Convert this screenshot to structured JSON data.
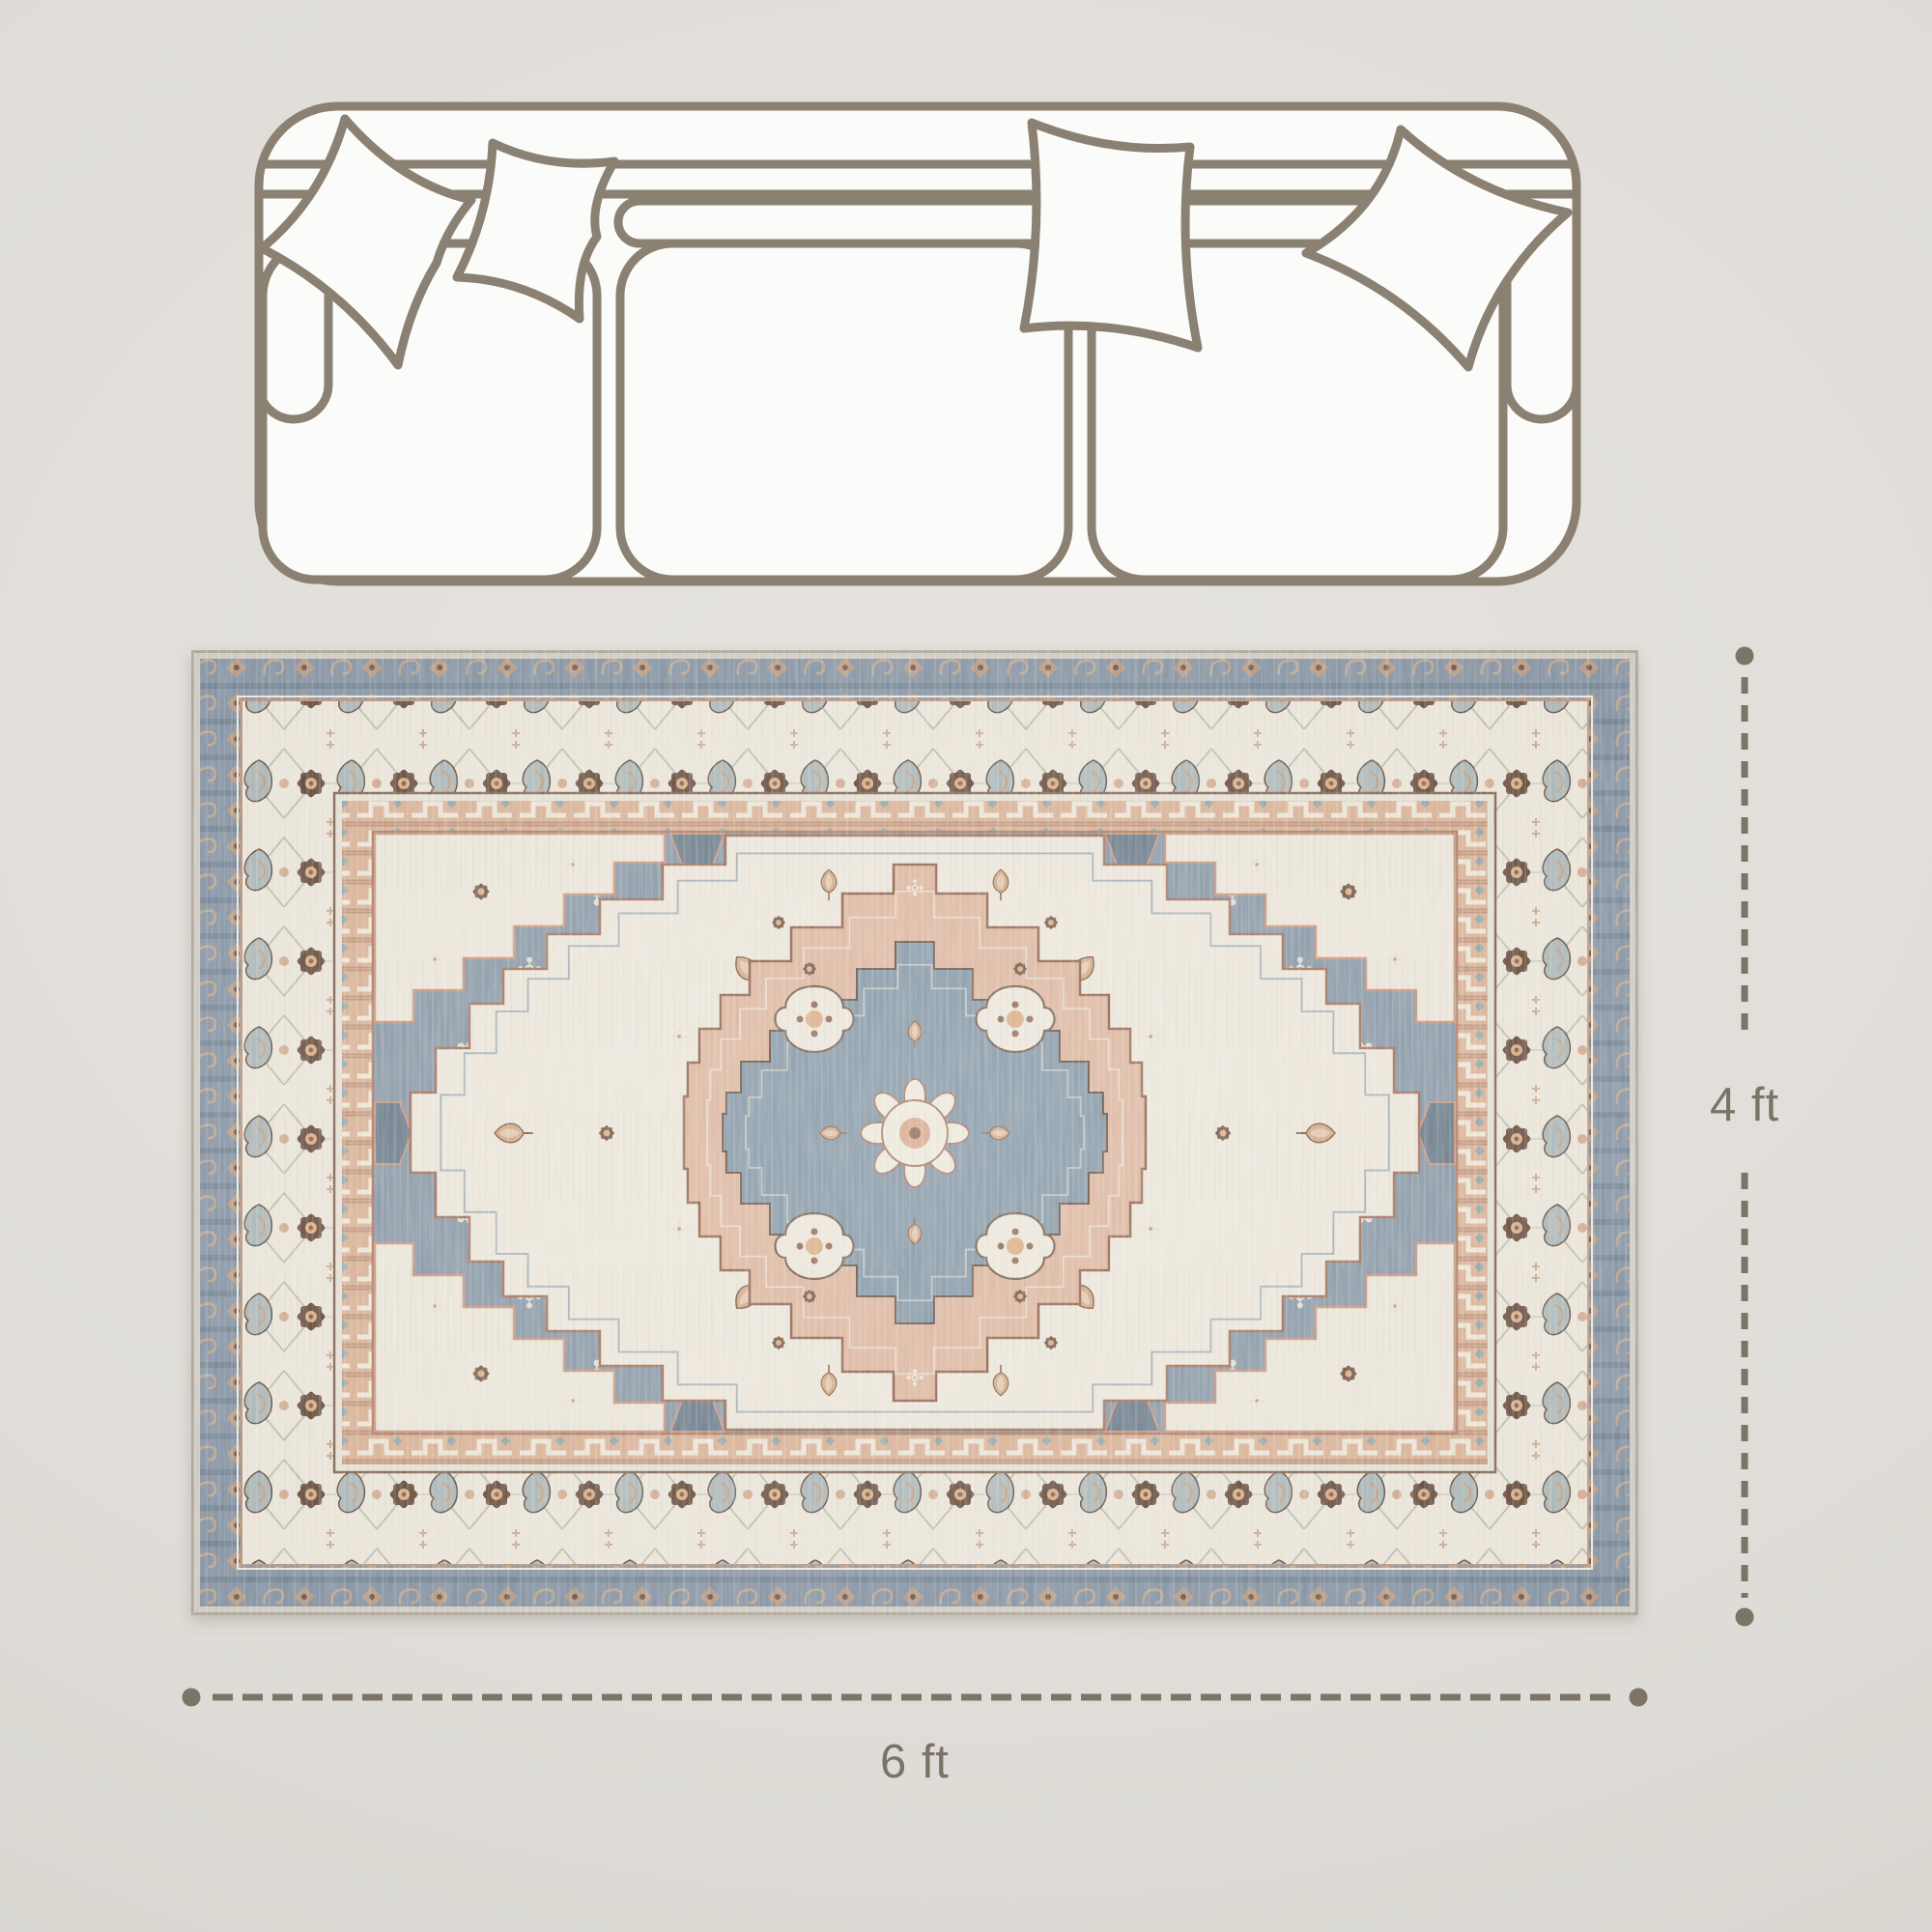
{
  "labels": {
    "height": "4 ft",
    "width": "6 ft"
  },
  "icons": {
    "sofa": "three-seat-sofa-top-view",
    "rug": "vintage-medallion-area-rug",
    "dimension_height": "vertical-dashed-dimension-line",
    "dimension_width": "horizontal-dashed-dimension-line"
  },
  "colors": {
    "page_background": "#e0ddd8",
    "sofa_outline": "#8a8172",
    "sofa_fill": "#fbfbf9",
    "dimension_line": "#7c7466",
    "dimension_text": "#7b7366",
    "rug_edge": "#cfc9c0",
    "rug_blue_band": "#8290a0",
    "rug_cream": "#e9e3d7",
    "rug_peach_band": "#d7ae92",
    "rug_field_blue": "#8494a3",
    "rug_medallion_peach": "#dab299",
    "rug_medallion_blue": "#7e92a2",
    "rug_motif_brown": "#6b4c3c",
    "rug_motif_rust": "#a8765c"
  }
}
